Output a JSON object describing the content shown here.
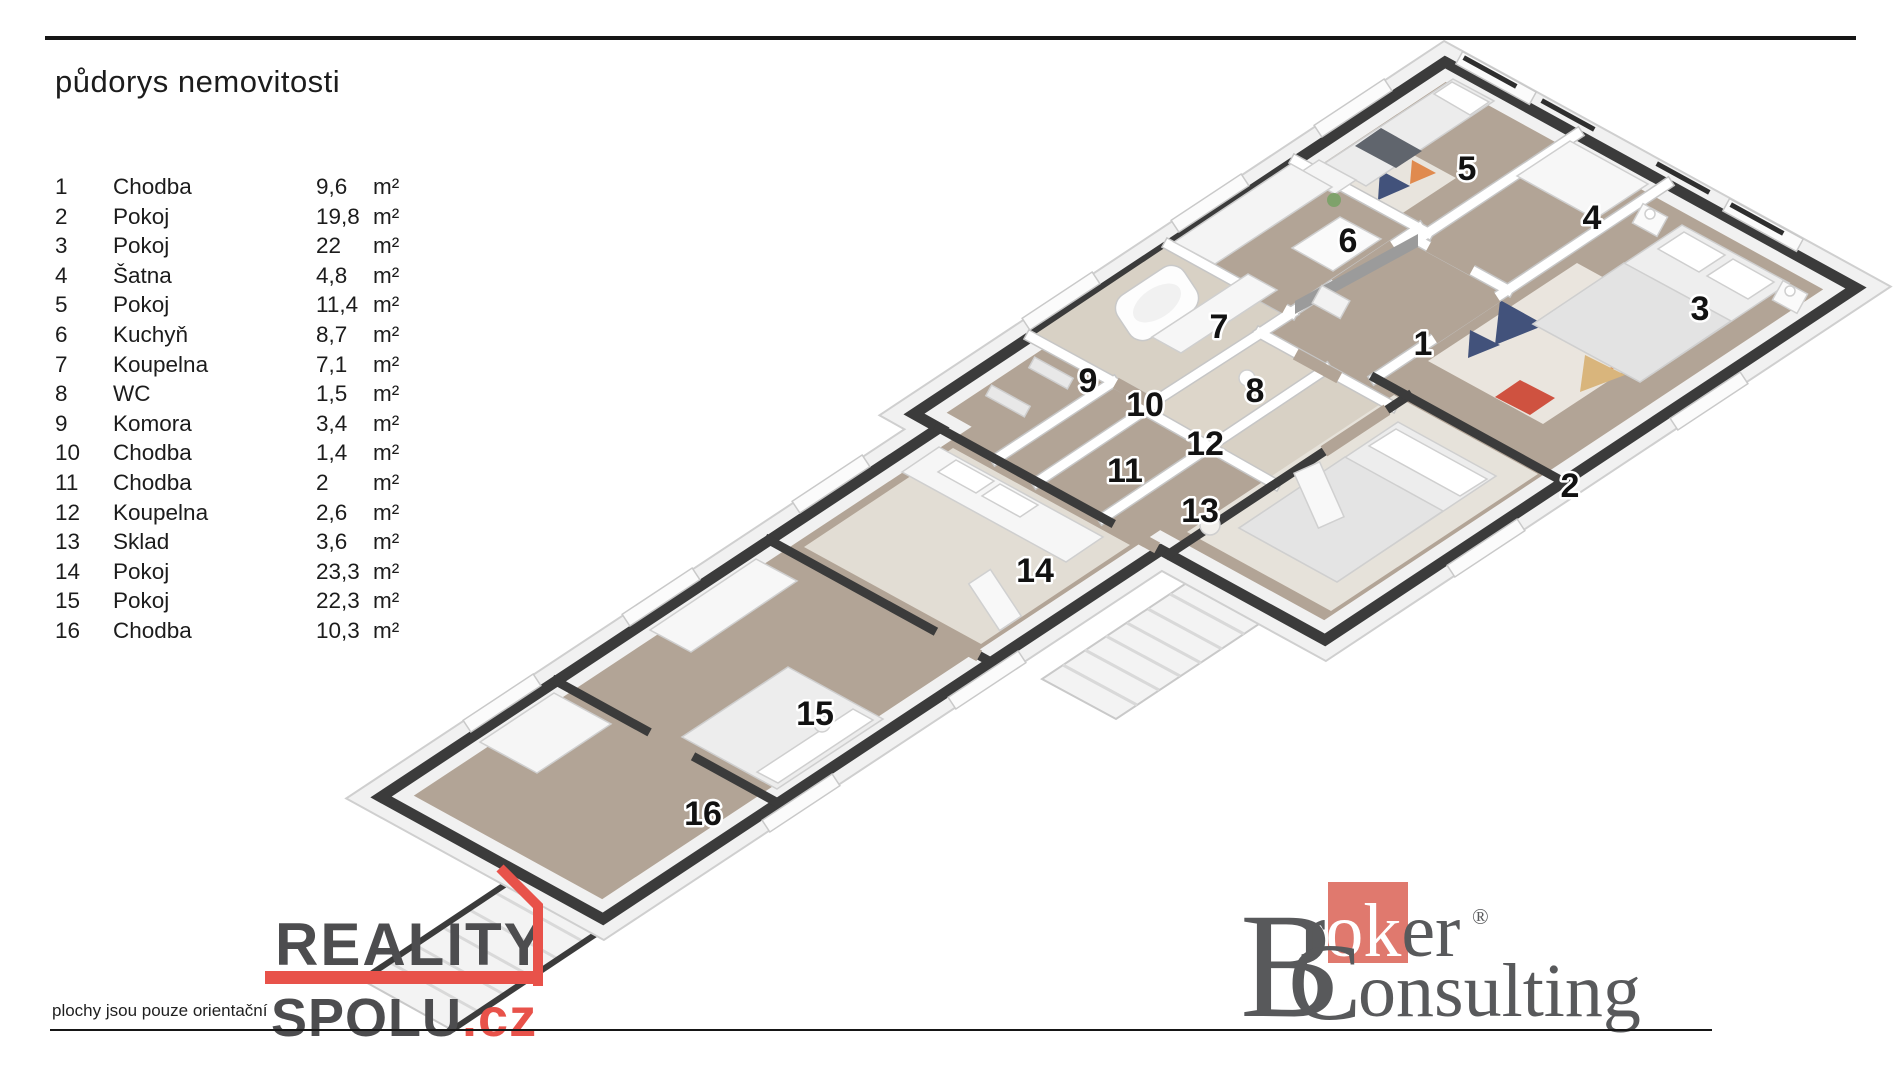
{
  "title": "půdorys nemovitosti",
  "legend": {
    "unit": "m²",
    "rows": [
      {
        "num": "1",
        "name": "Chodba",
        "area": "9,6"
      },
      {
        "num": "2",
        "name": "Pokoj",
        "area": "19,8"
      },
      {
        "num": "3",
        "name": "Pokoj",
        "area": "22"
      },
      {
        "num": "4",
        "name": "Šatna",
        "area": "4,8"
      },
      {
        "num": "5",
        "name": "Pokoj",
        "area": "11,4"
      },
      {
        "num": "6",
        "name": "Kuchyň",
        "area": "8,7"
      },
      {
        "num": "7",
        "name": "Koupelna",
        "area": "7,1"
      },
      {
        "num": "8",
        "name": "WC",
        "area": "1,5"
      },
      {
        "num": "9",
        "name": "Komora",
        "area": "3,4"
      },
      {
        "num": "10",
        "name": "Chodba",
        "area": "1,4"
      },
      {
        "num": "11",
        "name": "Chodba",
        "area": "2"
      },
      {
        "num": "12",
        "name": "Koupelna",
        "area": "2,6"
      },
      {
        "num": "13",
        "name": "Sklad",
        "area": "3,6"
      },
      {
        "num": "14",
        "name": "Pokoj",
        "area": "23,3"
      },
      {
        "num": "15",
        "name": "Pokoj",
        "area": "22,3"
      },
      {
        "num": "16",
        "name": "Chodba",
        "area": "10,3"
      }
    ]
  },
  "plan": {
    "room_labels": [
      "1",
      "2",
      "3",
      "4",
      "5",
      "6",
      "7",
      "8",
      "9",
      "10",
      "11",
      "12",
      "13",
      "14",
      "15",
      "16"
    ]
  },
  "footer": {
    "disclaimer": "plochy jsou pouze orientační",
    "reality_brand": {
      "line1": "REALITY",
      "line2": "SPOLU",
      "tld": ".cz"
    },
    "broker_brand": {
      "initial1": "B",
      "word1_pre": "r",
      "word1_boxed": "ok",
      "word1_post": "er",
      "reg": "®",
      "initial2": "C",
      "word2_rest": "onsulting"
    }
  },
  "colors": {
    "accent_red": "#e8524a",
    "reality_gray": "#4d4d4f",
    "broker_gray": "#58595b",
    "broker_salmon": "#e0796e",
    "wall_dark": "#3b3b3b",
    "floor_wood": "#b2a496",
    "floor_tile": "#d8d1c5"
  }
}
